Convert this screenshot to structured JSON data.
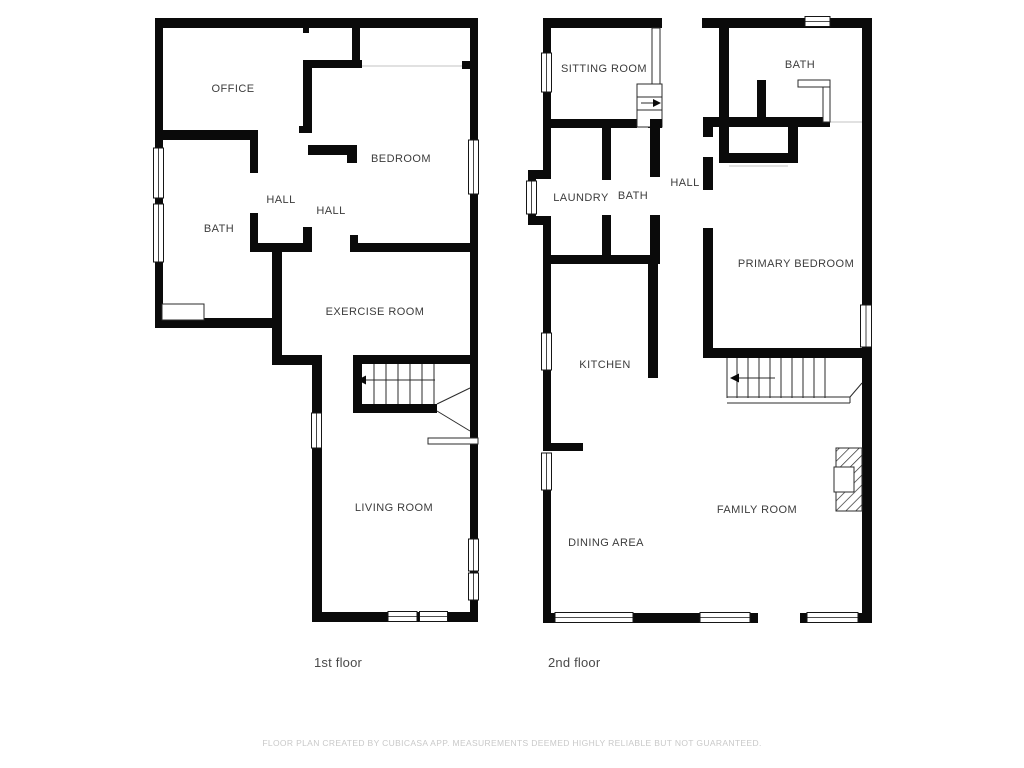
{
  "floor1": {
    "label": "1st floor",
    "rooms": {
      "office": "OFFICE",
      "bath": "BATH",
      "hall_a": "HALL",
      "hall_b": "HALL",
      "bedroom": "BEDROOM",
      "exercise_room": "EXERCISE ROOM",
      "living_room": "LIVING ROOM"
    }
  },
  "floor2": {
    "label": "2nd floor",
    "rooms": {
      "sitting_room": "SITTING ROOM",
      "bath_upper": "BATH",
      "laundry": "LAUNDRY",
      "bath": "BATH",
      "hall": "HALL",
      "primary_bedroom": "PRIMARY BEDROOM",
      "kitchen": "KITCHEN",
      "family_room": "FAMILY ROOM",
      "dining_area": "DINING AREA"
    }
  },
  "footer": {
    "disclaimer": "FLOOR PLAN CREATED BY CUBICASA APP. MEASUREMENTS DEEMED HIGHLY RELIABLE BUT NOT GUARANTEED."
  },
  "colors": {
    "wall": "#0a0a0a",
    "label_text": "#3c3c3c",
    "floor_label": "#4a4a4a",
    "muted_text": "#c9c9c9"
  }
}
